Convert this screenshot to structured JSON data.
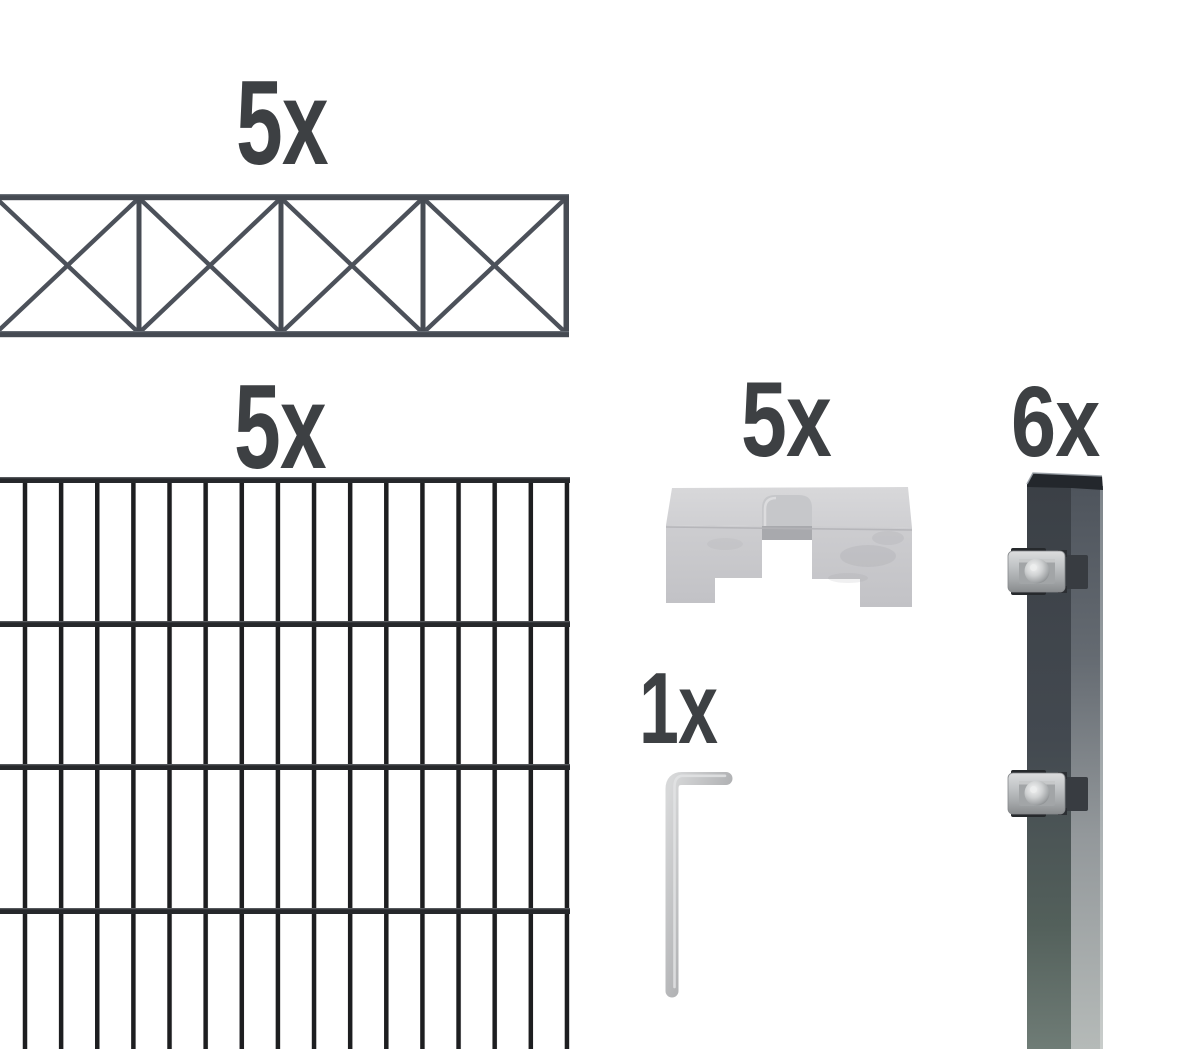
{
  "product_kit": {
    "background_color": "#ffffff",
    "label_color": "#3d4043",
    "items": [
      {
        "id": "cross-topper-panel",
        "quantity_label": "5x",
        "description": "decorative cross-brace fence topper panel",
        "wire_color": "#4b5057"
      },
      {
        "id": "double-rod-mesh-panel",
        "quantity_label": "5x",
        "description": "double rod mesh fence panel",
        "wire_color": "#1d1e20"
      },
      {
        "id": "cover-plate",
        "quantity_label": "5x",
        "description": "galvanized cover plate bracket",
        "metal_color": "#c9c9cc"
      },
      {
        "id": "hex-key",
        "quantity_label": "1x",
        "description": "allen key",
        "metal_color": "#b5b6b8"
      },
      {
        "id": "fence-post",
        "quantity_label": "6x",
        "description": "anthracite post with two clamps",
        "post_color": "#42474e",
        "clamp_color": "#c2c5c7"
      }
    ]
  }
}
